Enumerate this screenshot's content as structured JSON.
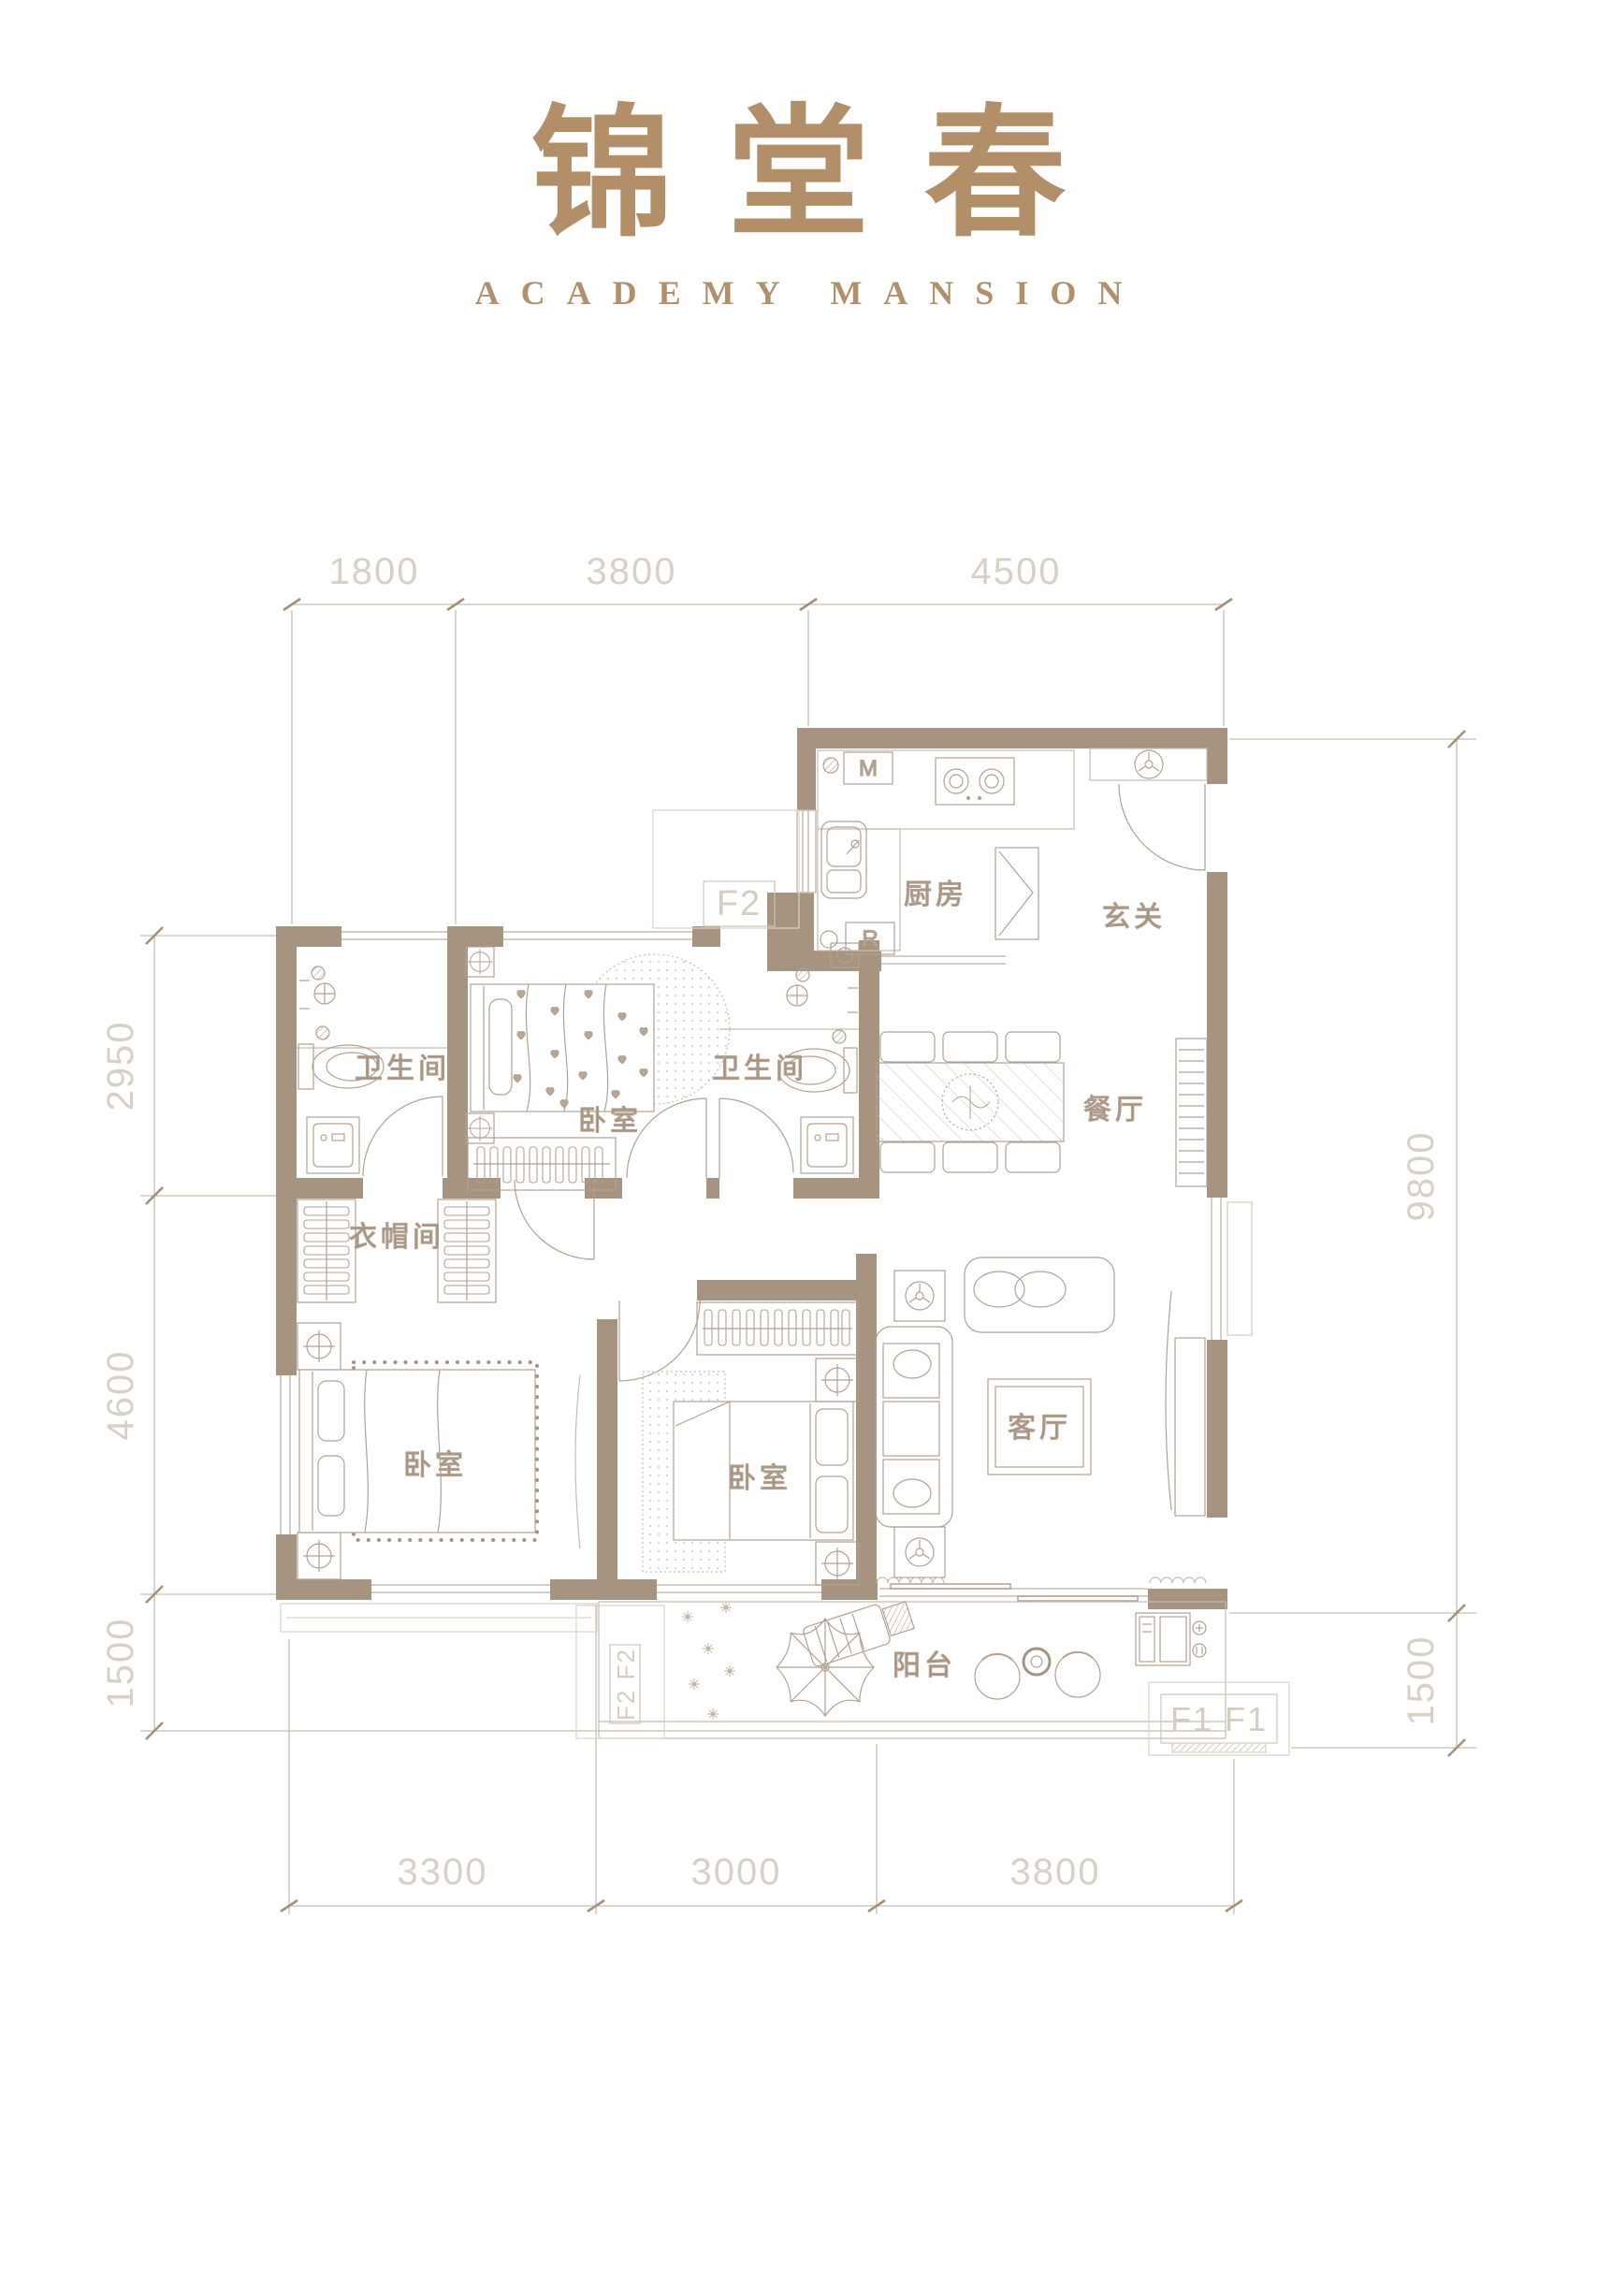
{
  "page": {
    "title": "锦堂春",
    "subtitle": "ACADEMY MANSION"
  },
  "plan": {
    "rooms": {
      "kitchen": "厨房",
      "entry": "玄关",
      "dining": "餐厅",
      "living": "客厅",
      "balcony": "阳台",
      "bath_left": "卫生间",
      "bath_right": "卫生间",
      "bedroom_top": "卧室",
      "bedroom_left": "卧室",
      "bedroom_mid": "卧室",
      "cloakroom": "衣帽间"
    },
    "markers": {
      "ac_top": "F2",
      "ac_balcony_left": "F2 F2",
      "ac_balcony_right": "F1  F1"
    },
    "appliances": {
      "m": "M",
      "r": "R"
    },
    "dims": {
      "top": [
        "1800",
        "3800",
        "4500"
      ],
      "bottom": [
        "3300",
        "3000",
        "3800"
      ],
      "left": [
        "2950",
        "4600",
        "1500"
      ],
      "right": [
        "9800",
        "1500"
      ]
    },
    "colors": {
      "wall": "#a69380",
      "line": "#b3a191",
      "line_light": "#cdc1b3",
      "title": "#b28f68",
      "room_text": "#a3907b",
      "dim_text": "#d9d0c5"
    }
  }
}
